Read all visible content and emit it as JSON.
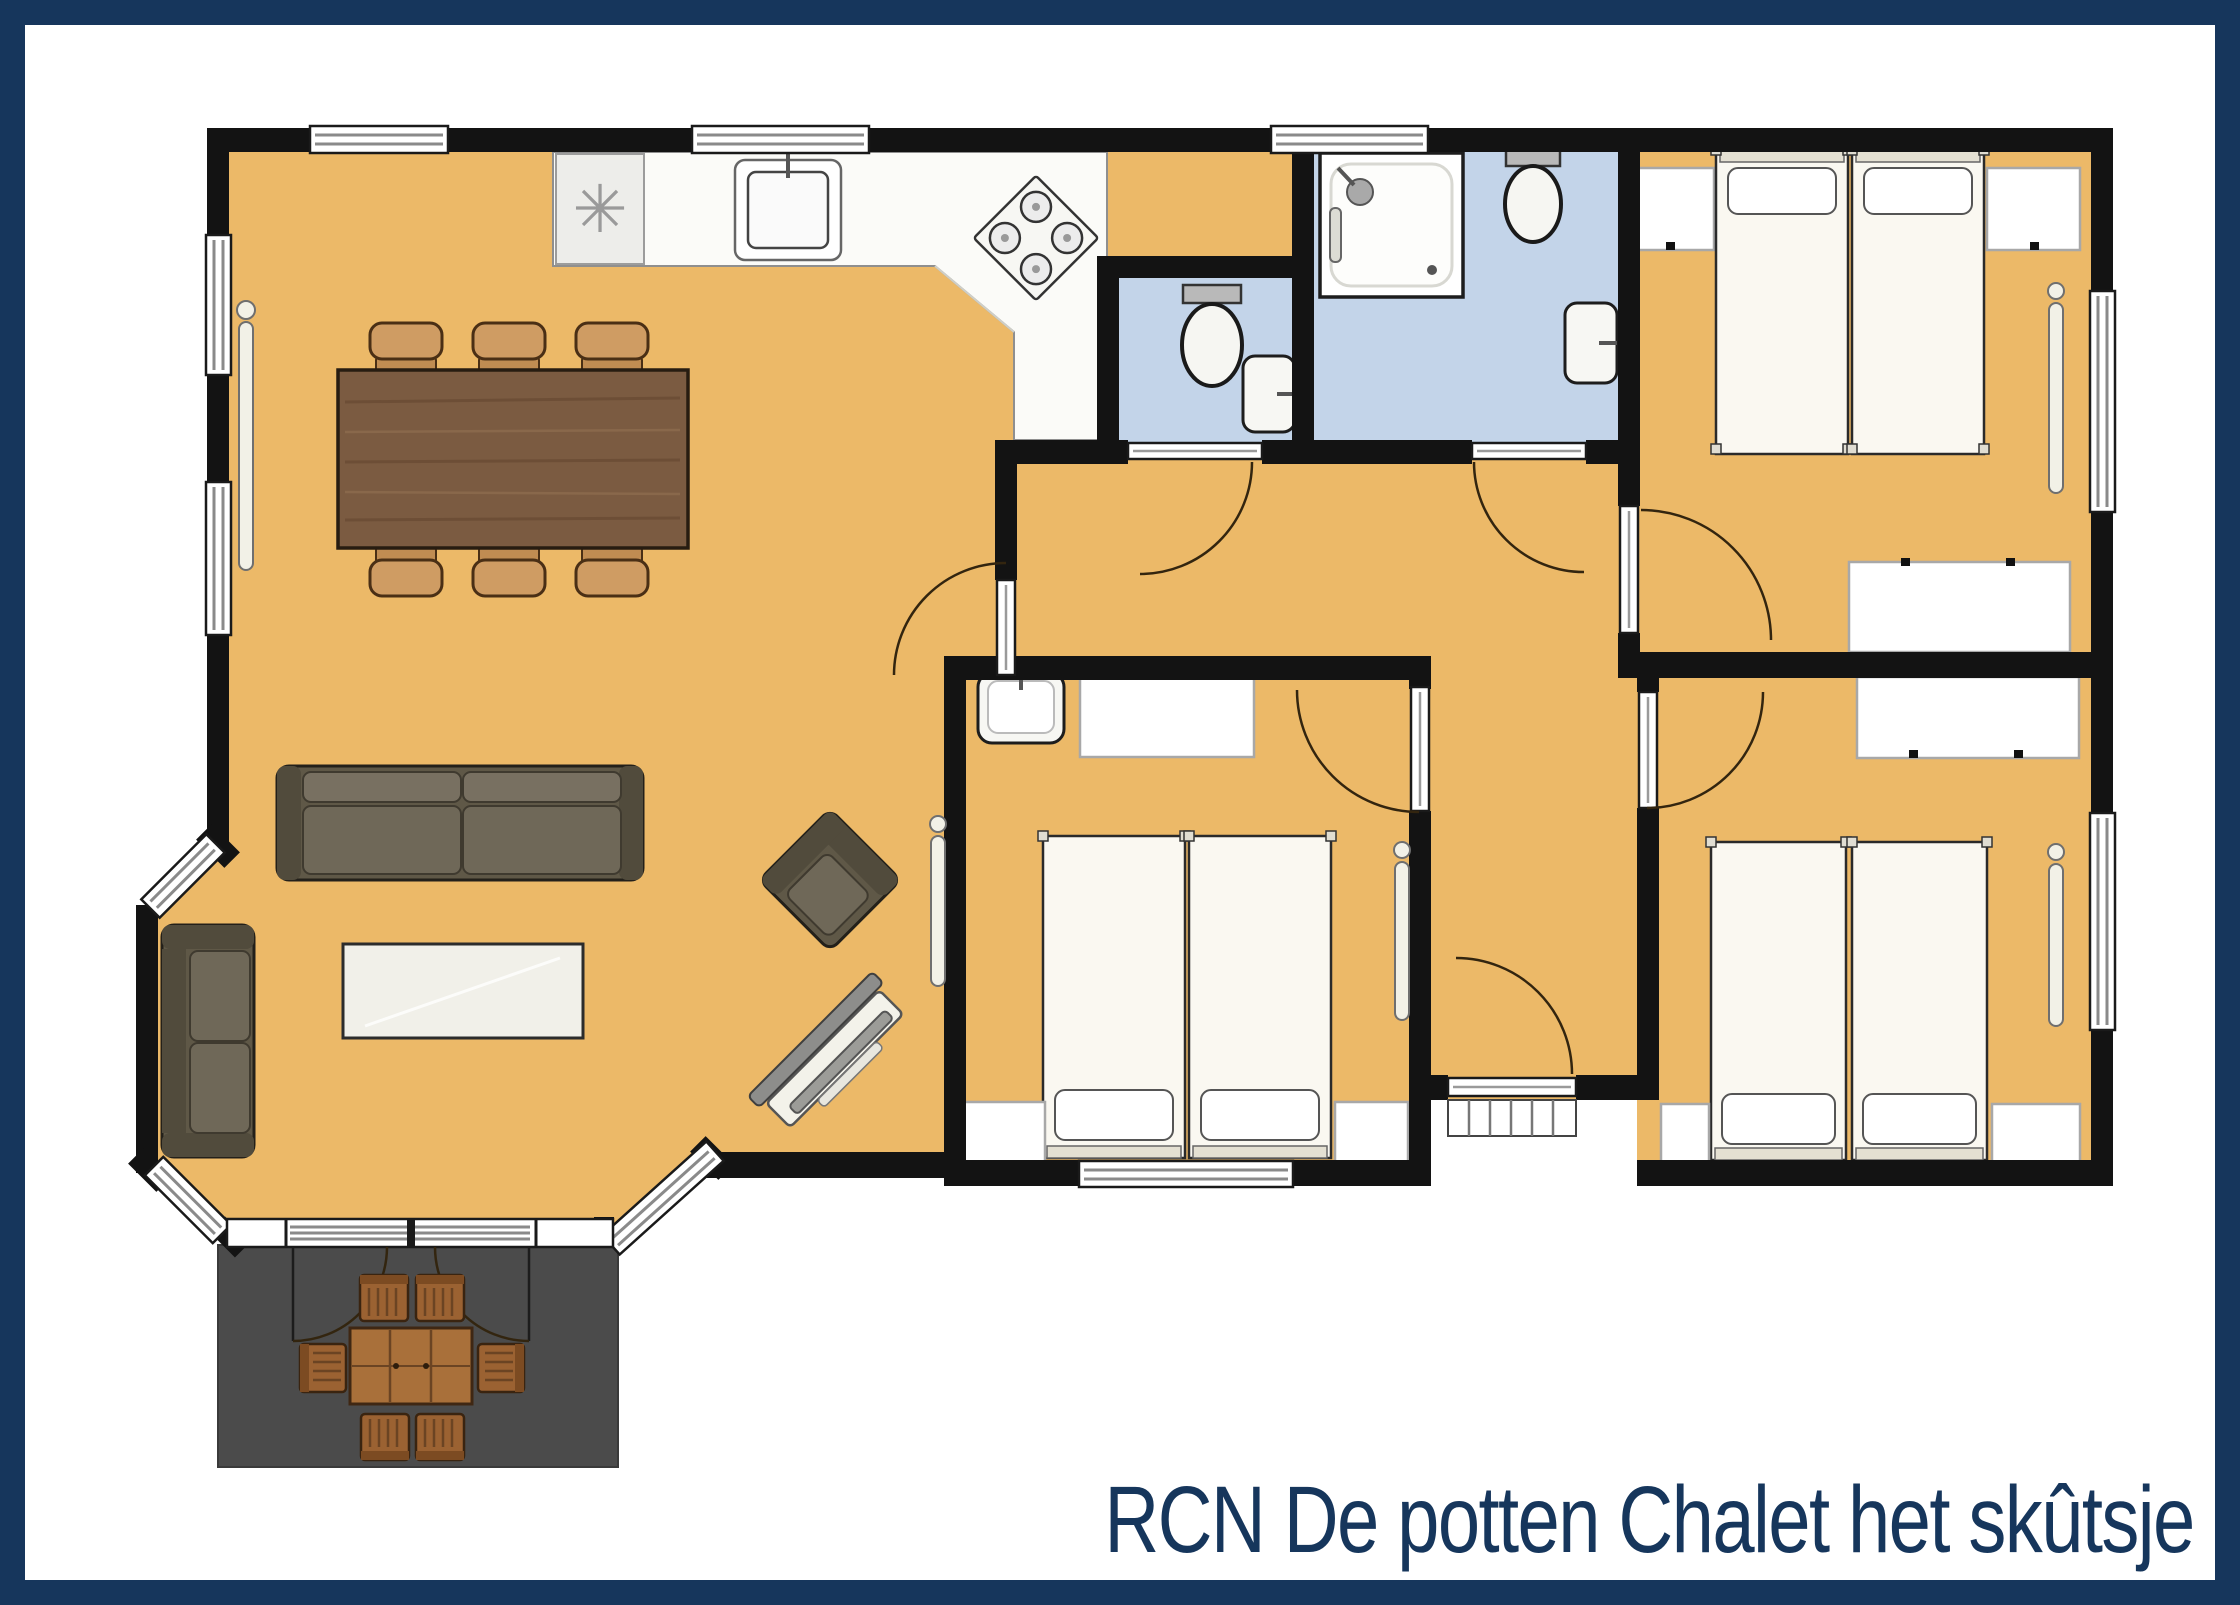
{
  "title": "RCN De potten Chalet het skûtsje",
  "symbols": {
    "freezer": "✳"
  },
  "colors": {
    "navy": "#16365c",
    "page": "#ffffff",
    "floor": "#ecb968",
    "wet": "#c3d4e9",
    "wall": "#131313",
    "terrace": "#4b4b4b",
    "counter": "#fbfbf8",
    "wood": "#7b5b41",
    "chairtan": "#cf9c63",
    "sofa": "#5f5847",
    "sofadark": "#514b3c",
    "cushion": "#6f6858",
    "outdoor": "#a9703a",
    "outdoordark": "#6b4423",
    "whitefurn": "#ffffff",
    "line": "#1a1a1a"
  },
  "rooms": [
    {
      "name": "living-dining-room"
    },
    {
      "name": "kitchen"
    },
    {
      "name": "hallway"
    },
    {
      "name": "wc"
    },
    {
      "name": "shower-room"
    },
    {
      "name": "bedroom-top-right"
    },
    {
      "name": "bedroom-middle"
    },
    {
      "name": "bedroom-bottom-right"
    },
    {
      "name": "terrace"
    }
  ],
  "furniture_counts": {
    "single_beds": 6,
    "dining_chairs": 6,
    "outdoor_chairs": 6,
    "sofas": 2,
    "armchairs": 1,
    "wardrobes": 2,
    "toilets": 3,
    "sinks": 4,
    "showers": 1
  }
}
